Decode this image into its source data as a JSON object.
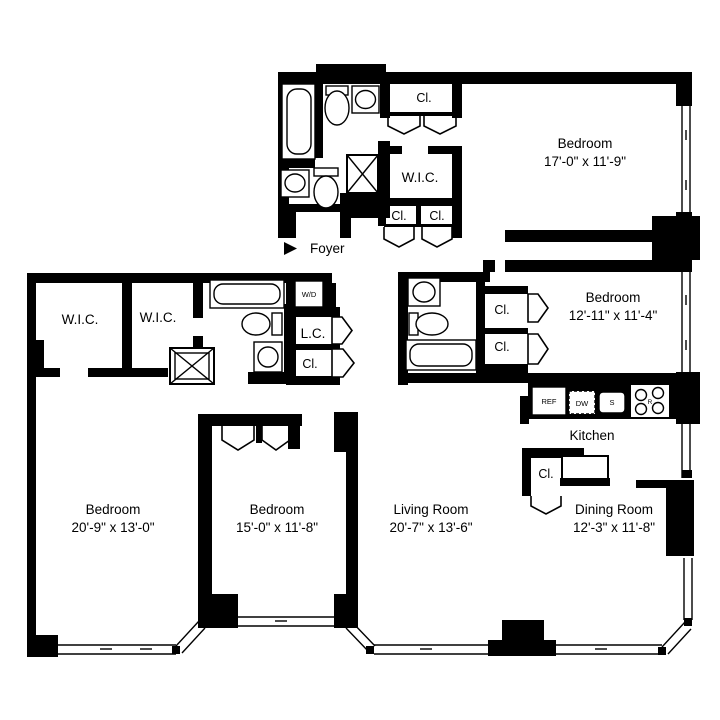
{
  "plan": {
    "title": "Apartment floor plan",
    "rooms": [
      {
        "name": "Bedroom",
        "dims": "17'-0\" x 11'-9\""
      },
      {
        "name": "Bedroom",
        "dims": "12'-11\" x 11'-4\""
      },
      {
        "name": "Bedroom",
        "dims": "20'-9\" x 13'-0\""
      },
      {
        "name": "Bedroom",
        "dims": "15'-0\" x 11'-8\""
      },
      {
        "name": "Living Room",
        "dims": "20'-7\" x 13'-6\""
      },
      {
        "name": "Dining Room",
        "dims": "12'-3\" x 11'-8\""
      },
      {
        "name": "Kitchen",
        "dims": ""
      },
      {
        "name": "Foyer",
        "dims": ""
      }
    ],
    "labels": {
      "closet": "Cl.",
      "walk_in_closet": "W.I.C.",
      "linen_closet": "L.C.",
      "washer_dryer": "W/D"
    },
    "appliances": {
      "refrigerator": "REF",
      "dishwasher": "DW",
      "sink": "S",
      "range": "R"
    },
    "colors": {
      "wall": "#000000",
      "floor": "#ffffff",
      "text": "#000000"
    }
  }
}
